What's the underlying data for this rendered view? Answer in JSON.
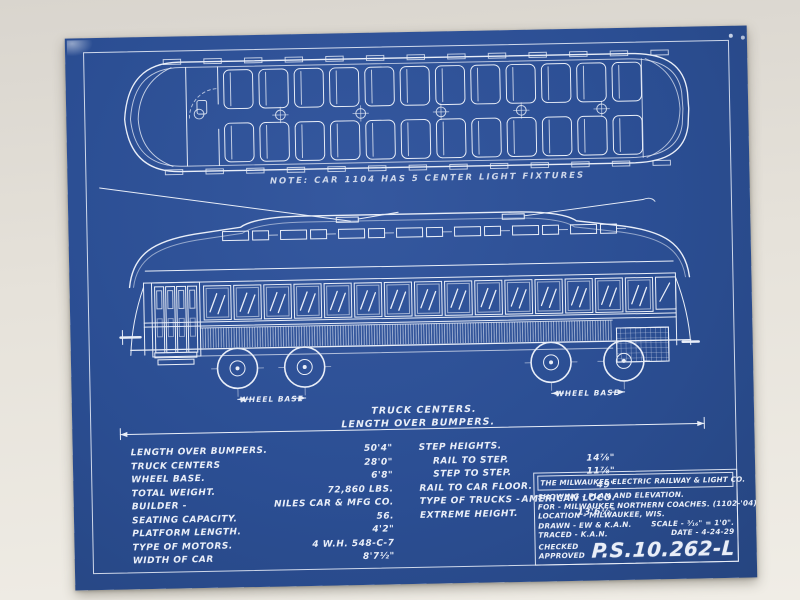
{
  "colors": {
    "paper_blue": "#2b4e93",
    "line_white": "#e9eef8",
    "backdrop": "#e4e0d8"
  },
  "plan": {
    "note": "NOTE: CAR 1104 HAS 5 CENTER LIGHT FIXTURES",
    "seats_per_side": 12,
    "center_light_fixtures": 5
  },
  "elevation": {
    "window_count": 15,
    "clerestory_groups": 7,
    "wheel_positions": [
      0.19,
      0.31,
      0.75,
      0.88
    ]
  },
  "dimensions": {
    "wheel_base_left": "WHEEL BASE",
    "truck_centers": "TRUCK CENTERS.",
    "length_over_bumpers": "LENGTH OVER BUMPERS.",
    "wheel_base_right": "WHEEL BASE"
  },
  "specs": {
    "left": [
      {
        "label": "LENGTH OVER BUMPERS.",
        "value": "50'4\""
      },
      {
        "label": "TRUCK CENTERS",
        "value": "28'0\""
      },
      {
        "label": "WHEEL BASE.",
        "value": "6'8\""
      },
      {
        "label": "TOTAL WEIGHT.",
        "value": "72,860 LBS."
      },
      {
        "label": "BUILDER -",
        "value": "NILES CAR & MFG CO."
      },
      {
        "label": "SEATING CAPACITY.",
        "value": "56."
      },
      {
        "label": "PLATFORM LENGTH.",
        "value": "4'2\""
      },
      {
        "label": "TYPE OF MOTORS.",
        "value": "4 W.H. 548-C-7"
      },
      {
        "label": "WIDTH OF CAR",
        "value": "8'7½\""
      }
    ],
    "right": [
      {
        "label": "STEP HEIGHTS.",
        "value": ""
      },
      {
        "label": "RAIL TO STEP.",
        "value": "14⅞\""
      },
      {
        "label": "STEP TO STEP.",
        "value": "11⅞\""
      },
      {
        "label": "RAIL TO CAR FLOOR.",
        "value": "49\""
      },
      {
        "label": "TYPE OF TRUCKS -",
        "value": "AMERICAN LOCO."
      },
      {
        "label": "EXTREME HEIGHT.",
        "value": "13'6½\""
      }
    ]
  },
  "title_block": {
    "company": "THE MILWAUKEE ELECTRIC RAILWAY & LIGHT CO.",
    "showing": "SHOWING - PLAN AND ELEVATION.",
    "for_line": "FOR - MILWAUKEE NORTHERN COACHES. (1102-'04)",
    "location": "LOCATION - MILWAUKEE, WIS.",
    "drawn": "DRAWN - EW & K.A.N.",
    "scale": "SCALE - ³⁄₁₆\" = 1'0\".",
    "traced": "TRACED - K.A.N.",
    "date": "DATE - 4-24-29",
    "checked": "CHECKED",
    "approved": "APPROVED",
    "drawing_number": "P.S.10.262-L"
  }
}
